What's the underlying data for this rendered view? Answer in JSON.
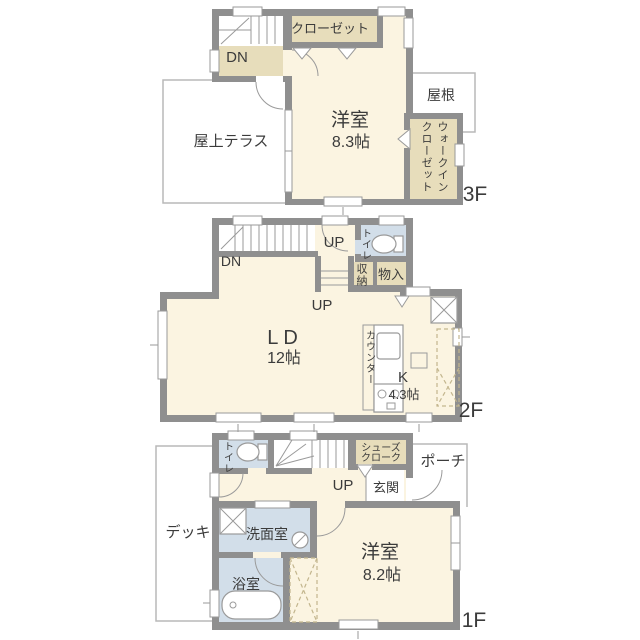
{
  "title": "3-story house floor plan",
  "colors": {
    "wall": "#8f8f8f",
    "room_cream": "#fbf4e1",
    "closet_tan": "#e7ddbb",
    "wet_blue": "#d2dee9",
    "outline": "#b9b9b9",
    "fixture_line": "#9a9a9a",
    "text": "#3b3b3b",
    "bg": "#ffffff"
  },
  "floor3": {
    "label": "3F",
    "closet": "クローゼット",
    "dn": "DN",
    "room_name": "洋室",
    "room_size": "8.3帖",
    "roof": "屋根",
    "terrace": "屋上テラス",
    "wic_col1": "ウォークイン",
    "wic_col2": "クローゼット"
  },
  "floor2": {
    "label": "2F",
    "up_top": "UP",
    "toilet": "トイレ",
    "dn": "DN",
    "storage_closet": "収納",
    "storage_cabinet": "物入",
    "up_bottom": "UP",
    "living_name": "LD",
    "living_size": "12帖",
    "counter": "カウンター",
    "kitchen_name": "K",
    "kitchen_size": "4.3帖"
  },
  "floor1": {
    "label": "1F",
    "toilet": "トイレ",
    "shoe_closet_line1": "シューズ",
    "shoe_closet_line2": "クローク",
    "porch": "ポーチ",
    "up": "UP",
    "entrance": "玄関",
    "deck": "デッキ",
    "washroom": "洗面室",
    "bathroom": "浴室",
    "room_name": "洋室",
    "room_size": "8.2帖"
  }
}
